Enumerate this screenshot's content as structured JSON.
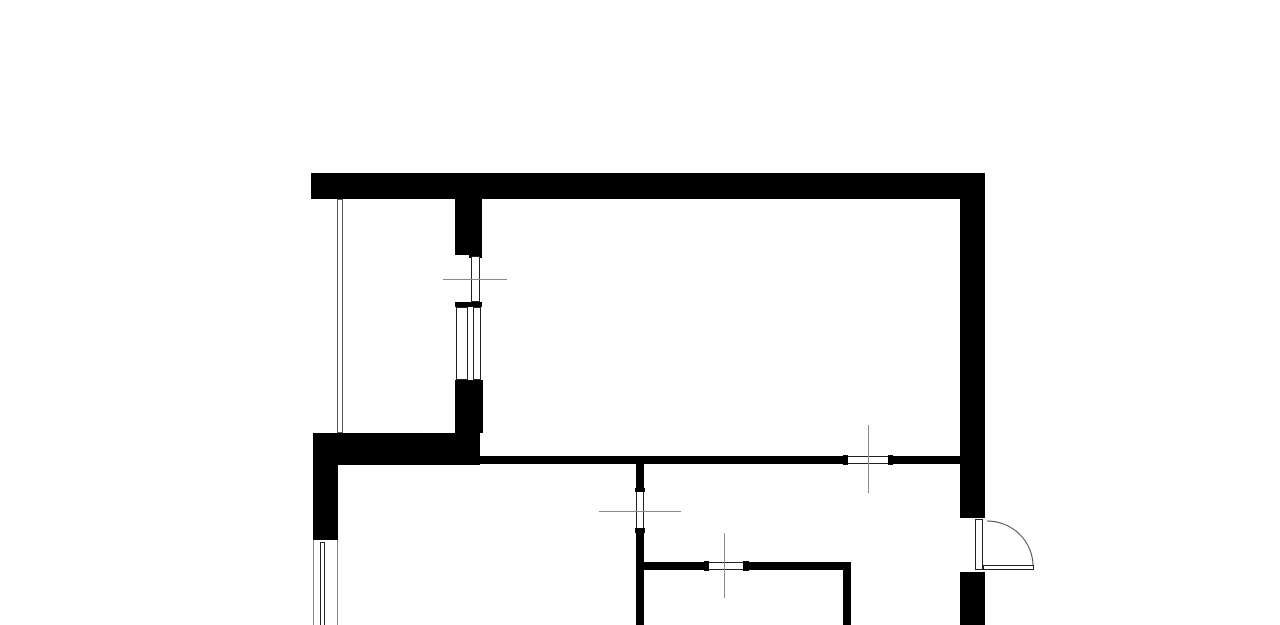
{
  "canvas": {
    "width": 1280,
    "height": 625,
    "background": "#ffffff"
  },
  "palette": {
    "wall": "#000000",
    "frame_line": "#222222",
    "crosshair_line": "#8a8a8a",
    "window_outer_line": "#8a8a8a",
    "glazing_line": "#555555",
    "swing_arc": "#4a4a4a",
    "miter_seam": "#3c3c3c"
  },
  "floorplan": {
    "walls": [
      {
        "name": "top-exterior-wall",
        "x": 311,
        "y": 173,
        "w": 674,
        "h": 26,
        "fill": "#000000"
      },
      {
        "name": "right-exterior-wall-upper",
        "x": 960,
        "y": 174,
        "w": 25,
        "h": 344,
        "fill": "#000000"
      },
      {
        "name": "right-exterior-wall-lower",
        "x": 960,
        "y": 572,
        "w": 25,
        "h": 53,
        "fill": "#000000"
      },
      {
        "name": "balcony-partition-wall-upper",
        "x": 455,
        "y": 199,
        "w": 27,
        "h": 56,
        "fill": "#000000"
      },
      {
        "name": "balcony-door-head-cap",
        "x": 469,
        "y": 255,
        "w": 13,
        "h": 3,
        "fill": "#000000"
      },
      {
        "name": "balcony-sill-bar",
        "x": 455,
        "y": 302,
        "w": 27,
        "h": 5,
        "fill": "#000000"
      },
      {
        "name": "balcony-partition-wall-lower",
        "x": 455,
        "y": 380,
        "w": 28,
        "h": 53,
        "fill": "#000000"
      },
      {
        "name": "left-thick-wall-horizontal",
        "x": 313,
        "y": 433,
        "w": 167,
        "h": 32,
        "fill": "#000000"
      },
      {
        "name": "left-thick-wall-vertical",
        "x": 313,
        "y": 433,
        "w": 25,
        "h": 107,
        "fill": "#000000"
      },
      {
        "name": "hall-wall-left-segment",
        "x": 475,
        "y": 456,
        "w": 368,
        "h": 8,
        "fill": "#000000"
      },
      {
        "name": "hall-window-cap-left",
        "x": 843,
        "y": 455,
        "w": 5,
        "h": 10,
        "fill": "#000000"
      },
      {
        "name": "hall-window-cap-right",
        "x": 888,
        "y": 455,
        "w": 5,
        "h": 10,
        "fill": "#000000"
      },
      {
        "name": "hall-wall-right-segment",
        "x": 893,
        "y": 456,
        "w": 67,
        "h": 8,
        "fill": "#000000"
      },
      {
        "name": "bath-wall-vertical-upper",
        "x": 636,
        "y": 456,
        "w": 8,
        "h": 32,
        "fill": "#000000"
      },
      {
        "name": "bath-door-cap-top",
        "x": 635,
        "y": 488,
        "w": 10,
        "h": 4,
        "fill": "#000000"
      },
      {
        "name": "bath-door-cap-bottom",
        "x": 635,
        "y": 528,
        "w": 10,
        "h": 5,
        "fill": "#000000"
      },
      {
        "name": "bath-wall-vertical-lower",
        "x": 636,
        "y": 533,
        "w": 8,
        "h": 92,
        "fill": "#000000"
      },
      {
        "name": "room-wall-horizontal-left",
        "x": 644,
        "y": 562,
        "w": 60,
        "h": 8,
        "fill": "#000000"
      },
      {
        "name": "room-door-cap-left",
        "x": 704,
        "y": 561,
        "w": 5,
        "h": 10,
        "fill": "#000000"
      },
      {
        "name": "room-door-cap-right",
        "x": 743,
        "y": 561,
        "w": 6,
        "h": 10,
        "fill": "#000000"
      },
      {
        "name": "room-wall-horizontal-right",
        "x": 749,
        "y": 562,
        "w": 101,
        "h": 8,
        "fill": "#000000"
      },
      {
        "name": "room-wall-vertical",
        "x": 843,
        "y": 562,
        "w": 8,
        "h": 63,
        "fill": "#000000"
      }
    ],
    "openings": [
      {
        "name": "balcony-door-leaf",
        "x": 471,
        "y": 256,
        "w": 9,
        "h": 46,
        "fill": "#ffffff",
        "stroke": "#222222",
        "sides": [
          "left",
          "right",
          "top",
          "bottom"
        ]
      },
      {
        "name": "balcony-window-frame",
        "x": 456,
        "y": 307,
        "w": 25,
        "h": 73,
        "fill": "#ffffff",
        "stroke": "#222222",
        "sides": [
          "left",
          "right",
          "top",
          "bottom"
        ]
      },
      {
        "name": "balcony-window-glazing",
        "x": 467,
        "y": 307,
        "w": 7,
        "h": 73,
        "fill": "#ffffff",
        "stroke": "#222222",
        "sides": [
          "left",
          "right"
        ]
      },
      {
        "name": "balcony-side-glazing",
        "x": 337,
        "y": 199,
        "w": 6,
        "h": 234,
        "fill": "#ffffff",
        "stroke": "#555555",
        "sides": [
          "left",
          "right",
          "top",
          "bottom"
        ]
      },
      {
        "name": "left-window-glazing",
        "x": 320,
        "y": 542,
        "w": 5,
        "h": 83,
        "fill": "#ffffff",
        "stroke": "#222222",
        "sides": [
          "left",
          "right",
          "top"
        ]
      },
      {
        "name": "hall-window",
        "x": 848,
        "y": 456,
        "w": 40,
        "h": 8,
        "fill": "#ffffff",
        "stroke": "#222222",
        "sides": [
          "top",
          "bottom"
        ]
      },
      {
        "name": "bath-door-opening",
        "x": 636,
        "y": 492,
        "w": 8,
        "h": 36,
        "fill": "#ffffff",
        "stroke": "#222222",
        "sides": [
          "left",
          "right"
        ]
      },
      {
        "name": "room-door-opening",
        "x": 709,
        "y": 562,
        "w": 34,
        "h": 8,
        "fill": "#ffffff",
        "stroke": "#222222",
        "sides": [
          "top",
          "bottom"
        ]
      },
      {
        "name": "entrance-door-frame",
        "x": 975,
        "y": 519,
        "w": 8,
        "h": 51,
        "fill": "#ffffff",
        "stroke": "#222222",
        "sides": [
          "left",
          "right",
          "top",
          "bottom"
        ]
      },
      {
        "name": "entrance-door-leaf",
        "x": 983,
        "y": 565,
        "w": 51,
        "h": 5,
        "fill": "#ffffff",
        "stroke": "#222222",
        "sides": [
          "left",
          "right",
          "top",
          "bottom"
        ]
      }
    ],
    "lines": [
      {
        "name": "left-window-outer-line-left",
        "x": 313,
        "y": 540,
        "len": 85,
        "dir": "v",
        "color": "#8a8a8a"
      },
      {
        "name": "left-window-outer-line-right",
        "x": 337,
        "y": 540,
        "len": 85,
        "dir": "v",
        "color": "#8a8a8a"
      },
      {
        "name": "crosshair-balcony-door",
        "x": 443,
        "y": 279,
        "len": 64,
        "dir": "h",
        "color": "#8a8a8a"
      },
      {
        "name": "crosshair-bath-door",
        "x": 599,
        "y": 511,
        "len": 82,
        "dir": "h",
        "color": "#8a8a8a"
      },
      {
        "name": "crosshair-room-door",
        "x": 724,
        "y": 533,
        "len": 65,
        "dir": "v",
        "color": "#8a8a8a"
      },
      {
        "name": "crosshair-hall-window",
        "x": 868,
        "y": 425,
        "len": 68,
        "dir": "v",
        "color": "#8a8a8a"
      }
    ],
    "arcs": [
      {
        "name": "entrance-door-swing-arc",
        "path": "M 987 521 A 46 45 0 0 1 1033 566",
        "color": "#4a4a4a"
      },
      {
        "name": "corner-miter-seam",
        "path": "M 962 199 L 984 175",
        "color": "#3c3c3c"
      }
    ]
  }
}
